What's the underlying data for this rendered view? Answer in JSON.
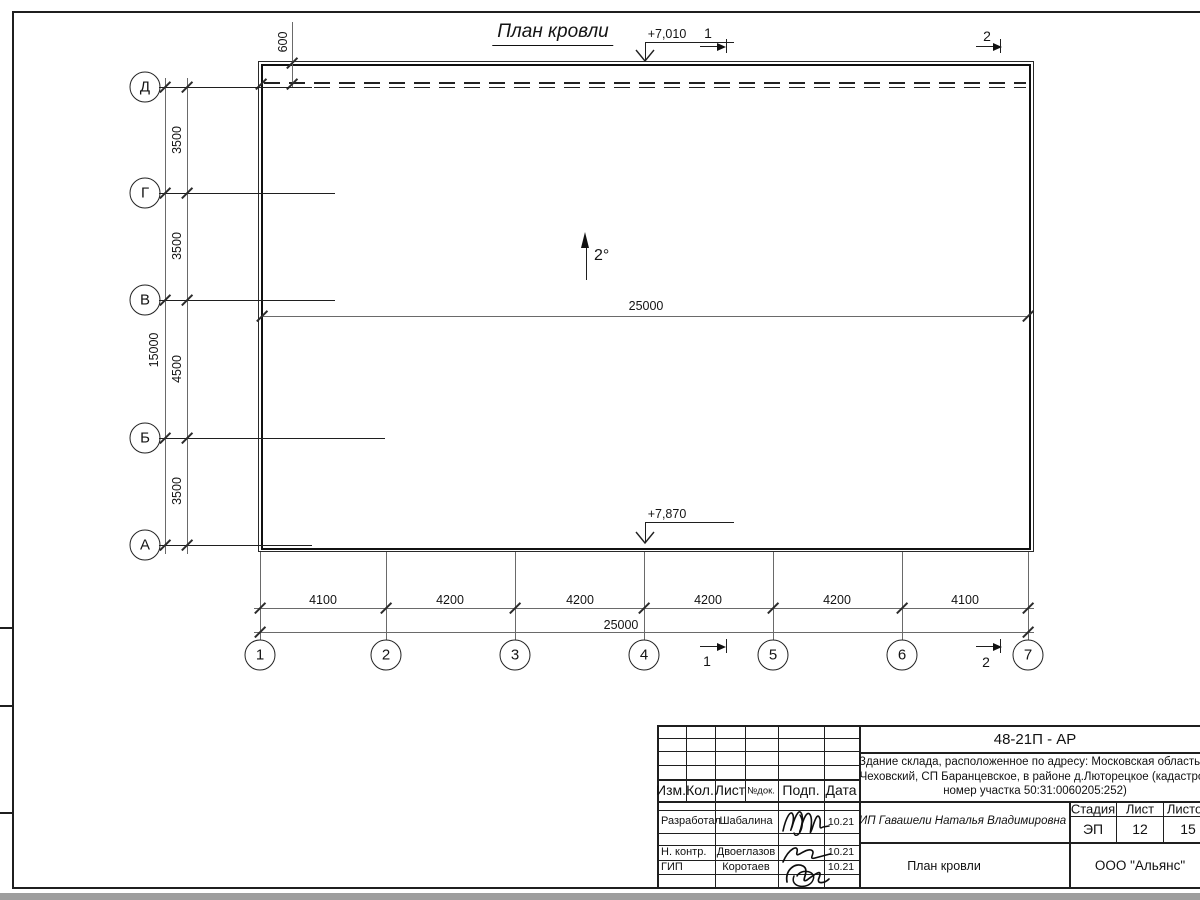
{
  "drawing": {
    "title": "План кровли",
    "slope": "2°",
    "roof_width_label": "25000",
    "parapet_offset": "600",
    "elevation_top": "+7,010",
    "elevation_bottom": "+7,870",
    "section_1": "1",
    "section_2": "2"
  },
  "axes": {
    "rows": [
      "Д",
      "Г",
      "В",
      "Б",
      "А"
    ],
    "cols": [
      "1",
      "2",
      "3",
      "4",
      "5",
      "6",
      "7"
    ],
    "row_dims": [
      "3500",
      "3500",
      "4500",
      "3500"
    ],
    "row_total": "15000",
    "col_dims": [
      "4100",
      "4200",
      "4200",
      "4200",
      "4200",
      "4100"
    ],
    "col_total": "25000"
  },
  "title_block": {
    "doc_code": "48-21П - АР",
    "address_line1": "Здание склада, расположенное по адресу: Московская область, р",
    "address_line2": "Чеховский, СП Баранцевское, в районе д.Люторецкое  (кадастров",
    "address_line3": "номер участка 50:31:0060205:252)",
    "cols": [
      "Изм.",
      "Кол.",
      "Лист",
      "№док.",
      "Подп.",
      "Дата"
    ],
    "staff": [
      {
        "role": "Разработал",
        "name": "Шабалина",
        "date": "10.21"
      },
      {
        "role": "Н. контр.",
        "name": "Двоеглазов",
        "date": "10.21"
      },
      {
        "role": "ГИП",
        "name": "Коротаев",
        "date": "10.21"
      }
    ],
    "client": "ИП Гавашели Наталья Владимировна",
    "stage_cols": [
      "Стадия",
      "Лист",
      "Листов"
    ],
    "stage_vals": [
      "ЭП",
      "12",
      "15"
    ],
    "sheet_name": "План кровли",
    "company": "ООО \"Альянс\""
  }
}
